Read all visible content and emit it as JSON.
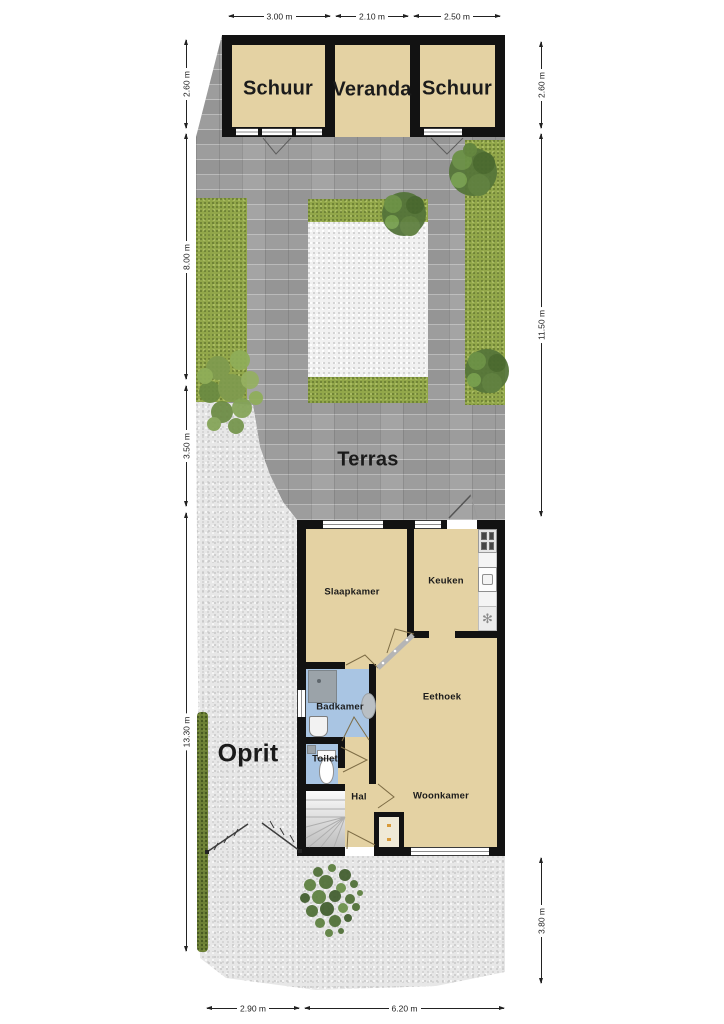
{
  "plan": {
    "outbuildings": {
      "schuur_left": "Schuur",
      "veranda": "Veranda",
      "schuur_right": "Schuur"
    },
    "outdoor": {
      "terras": "Terras",
      "oprit": "Oprit"
    },
    "rooms": {
      "slaapkamer": "Slaapkamer",
      "keuken": "Keuken",
      "badkamer": "Badkamer",
      "toilet": "Toilet",
      "hal": "Hal",
      "eethoek": "Eethoek",
      "woonkamer": "Woonkamer"
    },
    "dimensions": {
      "top": [
        "3.00 m",
        "2.10 m",
        "2.50 m"
      ],
      "left": [
        "2.60 m",
        "8.00 m",
        "3.50 m",
        "13.30 m"
      ],
      "right": [
        "2.60 m",
        "11.50 m",
        "3.80 m"
      ],
      "bottom": [
        "2.90 m",
        "6.20 m"
      ]
    },
    "symbols": {
      "extractor": "✻"
    },
    "colors": {
      "room_fill": "#e4d2a3",
      "wet_room_fill": "#a9c5e3",
      "wall": "#121212",
      "paving": "#9d9d9d",
      "gravel": "#e7e7e7",
      "grass": "#92a74a",
      "hedge": "#6b7f35"
    }
  }
}
